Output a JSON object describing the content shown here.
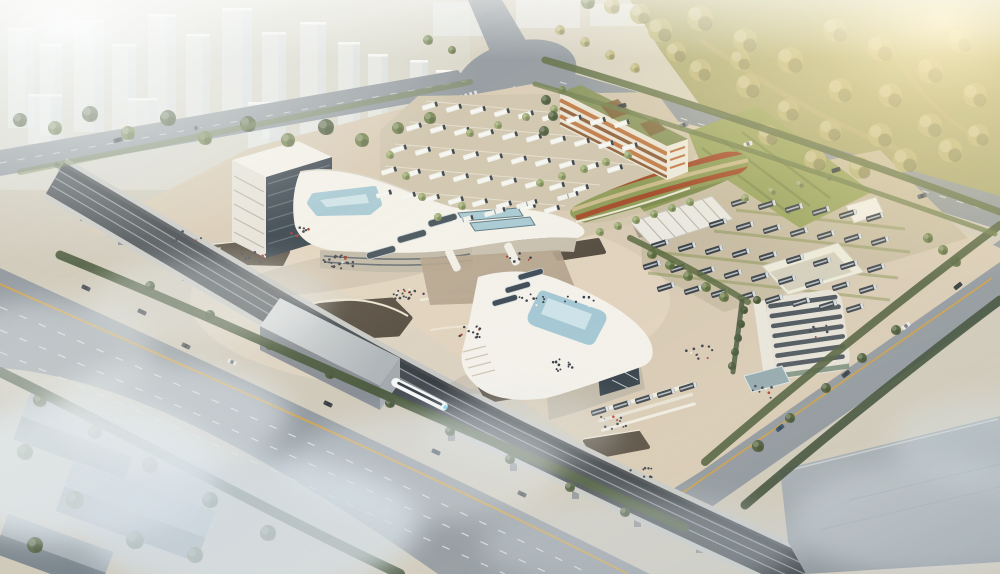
{
  "meta": {
    "title": "Aerial rendering of an intermodal transit hub with high-speed rail viaduct and bus depots",
    "type": "architectural-3d-rendering",
    "atmosphere": "hazy morning light, golden glow upper-right, mist lower-left"
  },
  "palette": {
    "base": "#cfc9ba",
    "plaza": "#d8cab4",
    "plazaGlow": "#efe2cc",
    "lotGround": "#cec3ac",
    "depotGround": "#c8bda4",
    "roadFill": "#8f979e",
    "roadEdge": "#b8bec2",
    "yellowLine": "#cf9d43",
    "laneDash": "#eef0f0",
    "viaductEdge": "#c7c8c5",
    "viaductBed": "#454b51",
    "railLight": "#9aa1a6",
    "buildingWhite": "#f3f1ea",
    "buildingShade": "#c7bfae",
    "wallBeige": "#bfb7a6",
    "glassDark": "#333f49",
    "poolBlue": "#a5c8d4",
    "poolLight": "#d3e7ec",
    "lawn": "#99a45f",
    "moundGreen": "#8d9a56",
    "moundRed": "#a34a28",
    "moundTan": "#c9b98a",
    "garageFace": "#e9e3d5",
    "garageOr1": "#bd7540",
    "garageOr2": "#8a5a35",
    "garageRoof": "#85915a",
    "shedRoof": "#eae8e0",
    "officeFace": "#e5e1d7",
    "officeBand": "#49535b",
    "annexGlass": "#8fa7ad",
    "warehouseTop": "#a7afb4",
    "warehouseSide": "#8d969c",
    "forestBase": "#a6a46e",
    "treeShades": [
      "#4c5c3a",
      "#6f7f4b",
      "#94a468",
      "#b8b178"
    ],
    "towerFace": "#edf1f2",
    "towerShade": "#d2d8dc",
    "busWhite": "#f1f2ee",
    "busDark": "#3c434a",
    "trainWhite": "#f5f7f7",
    "peopleColors": [
      "#3a3f49",
      "#b23a2c",
      "#f2f2ef"
    ]
  },
  "scene": {
    "towers": [
      [
        8,
        28,
        26,
        100
      ],
      [
        40,
        44,
        22,
        92
      ],
      [
        74,
        20,
        30,
        112
      ],
      [
        112,
        44,
        24,
        96
      ],
      [
        148,
        14,
        28,
        118
      ],
      [
        186,
        34,
        24,
        104
      ],
      [
        222,
        8,
        30,
        126
      ],
      [
        262,
        32,
        24,
        106
      ],
      [
        300,
        22,
        26,
        112
      ],
      [
        338,
        42,
        22,
        90
      ],
      [
        368,
        54,
        20,
        76
      ],
      [
        28,
        94,
        34,
        50
      ],
      [
        128,
        98,
        30,
        46
      ],
      [
        248,
        102,
        32,
        48
      ],
      [
        410,
        60,
        18,
        56
      ],
      [
        436,
        70,
        16,
        46
      ]
    ],
    "trees": [
      [
        20,
        120,
        7,
        0
      ],
      [
        55,
        128,
        7,
        1
      ],
      [
        90,
        114,
        8,
        0
      ],
      [
        128,
        133,
        7,
        1
      ],
      [
        168,
        118,
        8,
        0
      ],
      [
        205,
        138,
        7,
        1
      ],
      [
        248,
        124,
        8,
        0
      ],
      [
        288,
        140,
        7,
        1
      ],
      [
        326,
        127,
        8,
        0
      ],
      [
        362,
        140,
        7,
        1
      ],
      [
        398,
        128,
        6,
        1
      ],
      [
        430,
        118,
        6,
        1
      ],
      [
        470,
        133,
        4,
        2
      ],
      [
        498,
        125,
        4,
        2
      ],
      [
        526,
        117,
        4,
        2
      ],
      [
        554,
        109,
        4,
        2
      ],
      [
        390,
        155,
        4,
        2
      ],
      [
        406,
        176,
        4,
        2
      ],
      [
        422,
        197,
        4,
        2
      ],
      [
        438,
        217,
        4,
        2
      ],
      [
        462,
        206,
        4,
        2
      ],
      [
        540,
        183,
        4,
        2
      ],
      [
        562,
        176,
        4,
        2
      ],
      [
        584,
        169,
        4,
        2
      ],
      [
        606,
        162,
        4,
        2
      ],
      [
        628,
        155,
        4,
        2
      ],
      [
        546,
        100,
        5,
        0
      ],
      [
        553,
        116,
        5,
        0
      ],
      [
        544,
        131,
        5,
        0
      ],
      [
        562,
        90,
        4,
        1
      ],
      [
        600,
        232,
        4,
        2
      ],
      [
        618,
        226,
        4,
        2
      ],
      [
        636,
        220,
        4,
        2
      ],
      [
        654,
        214,
        4,
        2
      ],
      [
        672,
        208,
        4,
        2
      ],
      [
        690,
        202,
        4,
        2
      ],
      [
        652,
        254,
        5,
        1
      ],
      [
        670,
        265,
        5,
        1
      ],
      [
        688,
        276,
        5,
        1
      ],
      [
        706,
        287,
        5,
        1
      ],
      [
        724,
        297,
        5,
        1
      ],
      [
        745,
        198,
        4,
        2
      ],
      [
        772,
        191,
        4,
        2
      ],
      [
        800,
        184,
        4,
        2
      ],
      [
        828,
        177,
        4,
        2
      ],
      [
        928,
        238,
        5,
        1
      ],
      [
        943,
        250,
        5,
        1
      ],
      [
        956,
        262,
        5,
        1
      ],
      [
        744,
        310,
        4,
        0
      ],
      [
        741,
        324,
        4,
        0
      ],
      [
        738,
        338,
        4,
        0
      ],
      [
        735,
        352,
        4,
        0
      ],
      [
        732,
        366,
        4,
        0
      ],
      [
        757,
        300,
        4,
        0
      ],
      [
        896,
        330,
        5,
        0
      ],
      [
        862,
        358,
        5,
        0
      ],
      [
        826,
        388,
        5,
        0
      ],
      [
        790,
        418,
        5,
        0
      ],
      [
        758,
        446,
        6,
        0
      ],
      [
        150,
        286,
        5,
        0
      ],
      [
        210,
        315,
        5,
        0
      ],
      [
        270,
        345,
        5,
        0
      ],
      [
        330,
        374,
        5,
        0
      ],
      [
        390,
        403,
        5,
        0
      ],
      [
        450,
        431,
        5,
        0
      ],
      [
        510,
        459,
        5,
        0
      ],
      [
        570,
        487,
        5,
        0
      ],
      [
        625,
        512,
        5,
        0
      ],
      [
        40,
        400,
        7,
        0
      ],
      [
        95,
        432,
        7,
        0
      ],
      [
        150,
        465,
        8,
        0
      ],
      [
        210,
        500,
        8,
        0
      ],
      [
        268,
        533,
        8,
        0
      ],
      [
        25,
        452,
        8,
        0
      ],
      [
        75,
        500,
        9,
        0
      ],
      [
        135,
        540,
        9,
        0
      ],
      [
        35,
        545,
        8,
        0
      ],
      [
        195,
        555,
        8,
        0
      ],
      [
        660,
        30,
        12,
        3
      ],
      [
        700,
        18,
        13,
        3
      ],
      [
        745,
        40,
        12,
        3
      ],
      [
        700,
        70,
        11,
        3
      ],
      [
        748,
        86,
        12,
        3
      ],
      [
        790,
        60,
        13,
        3
      ],
      [
        835,
        30,
        12,
        3
      ],
      [
        880,
        48,
        13,
        3
      ],
      [
        840,
        90,
        12,
        3
      ],
      [
        890,
        95,
        12,
        3
      ],
      [
        930,
        70,
        13,
        3
      ],
      [
        960,
        40,
        12,
        3
      ],
      [
        975,
        95,
        12,
        3
      ],
      [
        930,
        125,
        12,
        3
      ],
      [
        880,
        135,
        12,
        3
      ],
      [
        830,
        130,
        11,
        3
      ],
      [
        788,
        110,
        11,
        3
      ],
      [
        768,
        135,
        10,
        3
      ],
      [
        815,
        160,
        11,
        3
      ],
      [
        860,
        168,
        11,
        3
      ],
      [
        905,
        160,
        12,
        3
      ],
      [
        950,
        150,
        12,
        3
      ],
      [
        978,
        135,
        11,
        3
      ],
      [
        740,
        60,
        10,
        3
      ],
      [
        676,
        52,
        10,
        3
      ],
      [
        640,
        14,
        10,
        3
      ],
      [
        612,
        6,
        8,
        3
      ],
      [
        588,
        2,
        7,
        1
      ],
      [
        428,
        40,
        5,
        1
      ],
      [
        452,
        50,
        4,
        1
      ],
      [
        560,
        30,
        5,
        3
      ],
      [
        585,
        42,
        5,
        3
      ],
      [
        610,
        55,
        5,
        3
      ],
      [
        635,
        68,
        5,
        3
      ]
    ],
    "hedges": [
      {
        "d": "M 60,255 C 220,320 380,395 560,470 C 620,498 655,514 685,528",
        "w": 9,
        "c": "#49593b",
        "o": 0.95
      },
      {
        "d": "M 0,372 C 120,430 260,508 400,574",
        "w": 10,
        "c": "#42523a",
        "o": 0.95
      },
      {
        "d": "M 1000,225 C 900,300 800,380 705,462",
        "w": 8,
        "c": "#4c5c3a",
        "o": 0.9
      },
      {
        "d": "M 1000,300 C 910,368 830,432 745,505",
        "w": 9,
        "c": "#3c4c36",
        "o": 0.9
      },
      {
        "d": "M 545,60 C 700,105 860,160 1000,212",
        "w": 7,
        "c": "#5c6b42",
        "o": 0.9
      },
      {
        "d": "M 535,84 C 700,132 860,186 995,234",
        "w": 5,
        "c": "#6b7a4a",
        "o": 0.8
      },
      {
        "d": "M 20,172 C 180,140 350,105 470,82",
        "w": 6,
        "c": "#72814f",
        "o": 0.55
      },
      {
        "d": "M 630,238 C 680,262 720,285 748,302",
        "w": 6,
        "c": "#5c6b42",
        "o": 0.85
      },
      {
        "d": "M 742,302 L 733,372",
        "w": 5,
        "c": "#45553a",
        "o": 0.85
      }
    ],
    "busRowsWhite": [
      {
        "x": 430,
        "y": 106,
        "n": 9,
        "sx": 24,
        "sy": 2.2
      },
      {
        "x": 414,
        "y": 127,
        "n": 10,
        "sx": 24,
        "sy": 2.2
      },
      {
        "x": 399,
        "y": 149,
        "n": 10,
        "sx": 24,
        "sy": 2.2
      },
      {
        "x": 389,
        "y": 171,
        "n": 9,
        "sx": 24,
        "sy": 2.2
      },
      {
        "x": 384,
        "y": 194,
        "n": 8,
        "sx": 24,
        "sy": 2.2
      }
    ],
    "busRowsDark": [
      {
        "x": 740,
        "y": 202,
        "n": 6,
        "sx": 27,
        "sy": 3
      },
      {
        "x": 718,
        "y": 223,
        "n": 7,
        "sx": 27,
        "sy": 3
      },
      {
        "x": 660,
        "y": 244,
        "n": 9,
        "sx": 27,
        "sy": 3
      },
      {
        "x": 652,
        "y": 265,
        "n": 9,
        "sx": 27,
        "sy": 3
      },
      {
        "x": 666,
        "y": 287,
        "n": 8,
        "sx": 27,
        "sy": 3
      },
      {
        "x": 600,
        "y": 411,
        "n": 5,
        "sx": 22,
        "sy": -6
      }
    ],
    "articulatedBuses": [
      [
        527,
        204
      ],
      [
        495,
        212
      ],
      [
        463,
        220
      ],
      [
        568,
        196
      ]
    ],
    "cars": [
      [
        622,
        106,
        -17,
        "#3a3f45"
      ],
      [
        684,
        125,
        -17,
        "#8a9096"
      ],
      [
        748,
        144,
        -17,
        "#e8eaea"
      ],
      [
        836,
        170,
        -17,
        "#33383d"
      ],
      [
        922,
        196,
        -17,
        "#55616b"
      ],
      [
        958,
        286,
        -38,
        "#2f353b"
      ],
      [
        906,
        326,
        -38,
        "#e8eaea"
      ],
      [
        846,
        374,
        -38,
        "#394049"
      ],
      [
        780,
        428,
        -38,
        "#31506e"
      ],
      [
        142,
        312,
        25,
        "#323840"
      ],
      [
        232,
        362,
        25,
        "#e6e8e8"
      ],
      [
        328,
        404,
        25,
        "#3a4046"
      ],
      [
        436,
        452,
        25,
        "#2e3f55"
      ],
      [
        522,
        494,
        25,
        "#454b50"
      ],
      [
        186,
        346,
        25,
        "#50565c"
      ],
      [
        86,
        288,
        25,
        "#3c424a"
      ],
      [
        118,
        140,
        -14,
        "#40454b"
      ],
      [
        196,
        128,
        -14,
        "#8f959b"
      ]
    ],
    "peopleClusters": [
      [
        340,
        262,
        26
      ],
      [
        408,
        296,
        20
      ],
      [
        470,
        332,
        16
      ],
      [
        532,
        300,
        10
      ],
      [
        562,
        366,
        14
      ],
      [
        612,
        422,
        12
      ],
      [
        302,
        232,
        8
      ],
      [
        252,
        256,
        8
      ],
      [
        702,
        352,
        10
      ],
      [
        762,
        392,
        8
      ],
      [
        822,
        332,
        6
      ],
      [
        642,
        472,
        8
      ],
      [
        186,
        238,
        6
      ],
      [
        580,
        300,
        8
      ],
      [
        516,
        258,
        8
      ]
    ],
    "piers": [
      [
        118,
        232
      ],
      [
        182,
        268
      ],
      [
        448,
        428
      ],
      [
        510,
        458
      ],
      [
        572,
        486
      ],
      [
        634,
        514
      ],
      [
        696,
        540
      ],
      [
        80,
        208
      ]
    ]
  }
}
